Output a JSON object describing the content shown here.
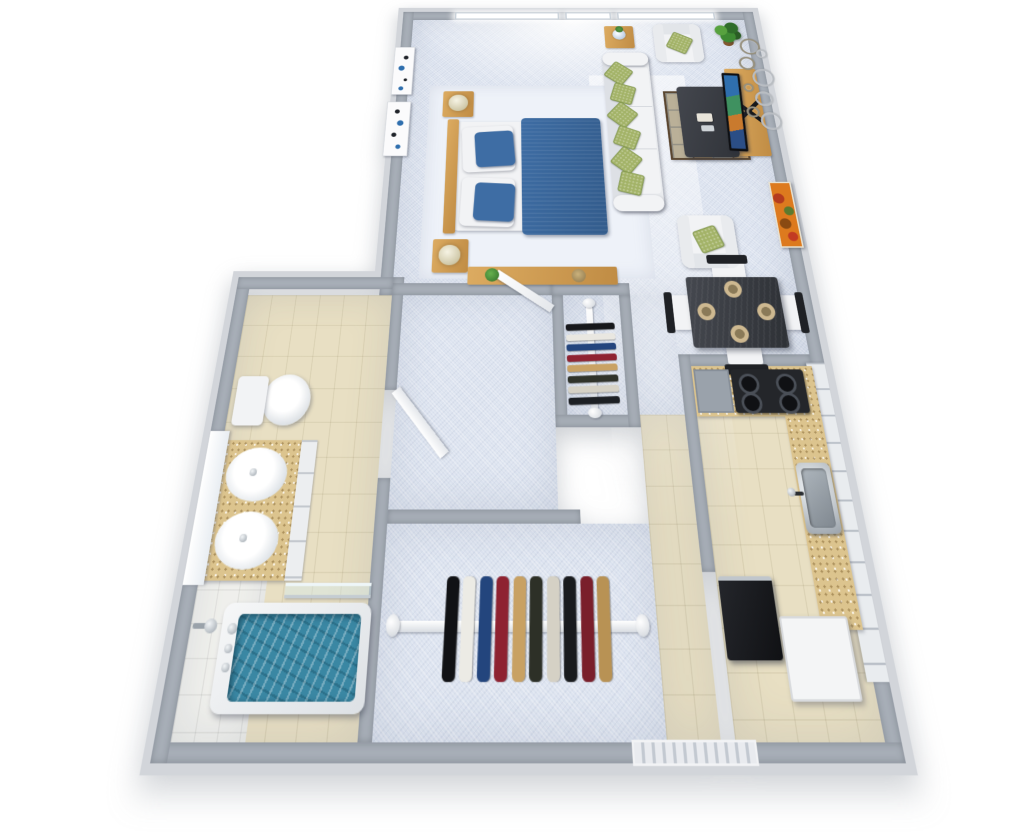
{
  "scene": {
    "description": "3D rendered top-down floor plan of a studio apartment",
    "view": "isometric overhead render, no text labels"
  },
  "palette": {
    "wall": "#a7aeb7",
    "wallOuter": "#d2d5da",
    "carpet": "#dde4f0",
    "rug": "#eef2f9",
    "tile": "#e8dfc3",
    "tileWhite": "#f2f2ee",
    "wood": "#dcab61",
    "woodDark": "#c08c44",
    "white": "#f2f3f5",
    "blue": "#3e6da4",
    "water": "#3a87a3",
    "green": "#a3b368",
    "greenDark": "#7d9448",
    "dark": "#3a3d43",
    "black": "#1b1d20",
    "granite": "#dcc48e",
    "chrome": "#c2c8ce",
    "orange": "#dd7a1e",
    "plant": "#3e7d33"
  },
  "rooms": [
    {
      "id": "bedroom",
      "floor": "carpet"
    },
    {
      "id": "living-room",
      "floor": "carpet"
    },
    {
      "id": "dining-area",
      "floor": "carpet"
    },
    {
      "id": "kitchen",
      "floor": "tile"
    },
    {
      "id": "entry-hall",
      "floor": "tile"
    },
    {
      "id": "hallway",
      "floor": "carpet"
    },
    {
      "id": "walk-in-closet",
      "floor": "carpet"
    },
    {
      "id": "small-closet",
      "floor": "carpet"
    },
    {
      "id": "bathroom",
      "floor": "tile"
    }
  ],
  "window": {
    "panes": 3,
    "location": "top wall"
  },
  "bedroom": {
    "items": [
      "double-bed",
      "blue-blanket",
      "pillows",
      "nightstand-with-lamp-left",
      "nightstand-with-lamp-right",
      "area-rug",
      "wall-art-dots-1",
      "wall-art-dots-2",
      "console-shelf",
      "small-plant",
      "round-tray"
    ]
  },
  "living": {
    "items": [
      "sofa",
      "green-throw-pillows",
      "armchair-top",
      "armchair-bottom",
      "coffee-table",
      "display-mat",
      "side-table",
      "flower-vase",
      "potted-plant",
      "tv-console",
      "flat-tv",
      "wall-circles-decor",
      "autumn-painting"
    ],
    "sofa_pillow_count": 6
  },
  "dining": {
    "place_settings": 4,
    "chairs": 4,
    "items": [
      "dark-dining-table",
      "plates",
      "chairs"
    ]
  },
  "kitchen": {
    "burners": 4,
    "items": [
      "gas-cooktop",
      "counter-granite",
      "sink-stainless",
      "tall-white-cabinets",
      "refrigerator",
      "white-island-counter",
      "gray-cabinet"
    ]
  },
  "bathroom": {
    "items": [
      "toilet",
      "double-sink-vanity",
      "mirror",
      "bathtub-with-water",
      "towel-bar",
      "shower-head",
      "faucets",
      "open-door"
    ]
  },
  "closets": {
    "small": {
      "rod": "vertical",
      "clothes_colors": [
        "#17181b",
        "#e9e7e1",
        "#24457e",
        "#8f2332",
        "#c9a264",
        "#30332a",
        "#d6d2c6",
        "#1d2024"
      ]
    },
    "main": {
      "rod": "horizontal",
      "clothes_colors": [
        "#111215",
        "#ecebe5",
        "#23457d",
        "#8e2231",
        "#c8a163",
        "#2d3027",
        "#d5d1c5",
        "#191b1e",
        "#7a1f2b",
        "#b89254"
      ]
    }
  },
  "wall_decor": {
    "circles": [
      {
        "d": 24,
        "x": 8,
        "y": 0
      },
      {
        "d": 11,
        "x": 30,
        "y": 20
      },
      {
        "d": 18,
        "x": 2,
        "y": 34
      },
      {
        "d": 26,
        "x": 18,
        "y": 56
      },
      {
        "d": 9,
        "x": 2,
        "y": 82
      },
      {
        "d": 20,
        "x": 16,
        "y": 96
      },
      {
        "d": 13,
        "x": 0,
        "y": 122
      },
      {
        "d": 24,
        "x": 18,
        "y": 132
      }
    ],
    "paintings": [
      "abstract-dots-white-blue-1",
      "abstract-dots-white-blue-2",
      "autumn-orange-leaves"
    ]
  },
  "entry": {
    "threshold": "striped door track, bottom wall"
  }
}
